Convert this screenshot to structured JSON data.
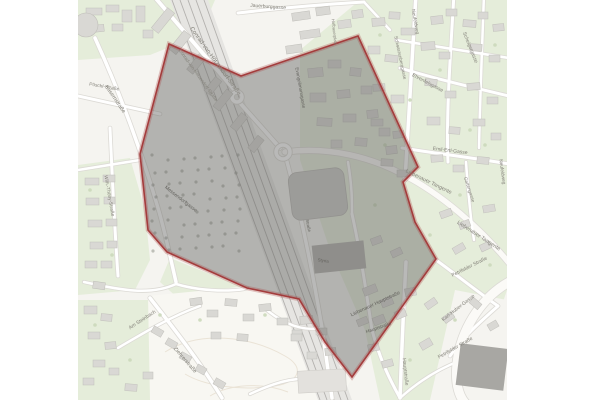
{
  "map": {
    "labels": [
      {
        "text": "Conrad-von-Hötzendorf-Straße"
      },
      {
        "text": "Conrad-von-Hötzendorf-Straße"
      },
      {
        "text": "Jauerburggasse"
      },
      {
        "text": "Kasernstraße"
      },
      {
        "text": "Pöschl-Straße"
      },
      {
        "text": "Wilh.-Thöny-Straße"
      },
      {
        "text": "Messendorfgasse"
      },
      {
        "text": "Evangelimanngasse"
      },
      {
        "text": "Scheigergasse"
      },
      {
        "text": "Schwarzenberggasse"
      },
      {
        "text": "Neufeldweg"
      },
      {
        "text": "Ehrenfelsgasse"
      },
      {
        "text": "Emil-Ertl-Gasse"
      },
      {
        "text": "Gartengasse"
      },
      {
        "text": "Liebenauer Tangente"
      },
      {
        "text": "Liebenauer Tangente"
      },
      {
        "text": "Neufeldweg"
      },
      {
        "text": "Petrifelder Straße"
      },
      {
        "text": "Karl-Huber-Gasse"
      },
      {
        "text": "Petrifelder Straße"
      },
      {
        "text": "Hauptstraße"
      },
      {
        "text": "Liebenauer Hauptstraße"
      },
      {
        "text": "Hauptstraße"
      },
      {
        "text": "Ziehrerstraße"
      },
      {
        "text": "Am Steinbach"
      },
      {
        "text": "Hofbauerplatz"
      },
      {
        "text": "Straße"
      },
      {
        "text": "Styria"
      }
    ],
    "boundary": {
      "points": [
        [
          169,
          44
        ],
        [
          241,
          76
        ],
        [
          358,
          36
        ],
        [
          418,
          167
        ],
        [
          403,
          182
        ],
        [
          415,
          222
        ],
        [
          436,
          259
        ],
        [
          352,
          377
        ],
        [
          325,
          342
        ],
        [
          299,
          299
        ],
        [
          247,
          288
        ],
        [
          167,
          252
        ],
        [
          148,
          230
        ],
        [
          140,
          154
        ]
      ],
      "stroke": "#a43c3c",
      "halo": "rgba(170,70,70,0.30)",
      "overlay_fill": "rgba(100,99,97,0.45)"
    },
    "colors": {
      "paper": "#f5f4f0",
      "field": "#f8f7f2",
      "green": "#e5edda",
      "building": "#d9d8d4",
      "building_stroke": "#c0bfba",
      "hall": "#cbcac7",
      "dark_slab": "#b2b1ad",
      "darker_slab": "#a8a7a3",
      "rail_band": "#e6e5e2",
      "rail_line": "#b3b1ae",
      "road": "#ffffff",
      "road_casing": "#dcdad5",
      "major_road": "#fbfaf7",
      "contour": "#eae3d6",
      "tree": "#cbd8ba",
      "tree_dark": "#8f948a"
    }
  }
}
